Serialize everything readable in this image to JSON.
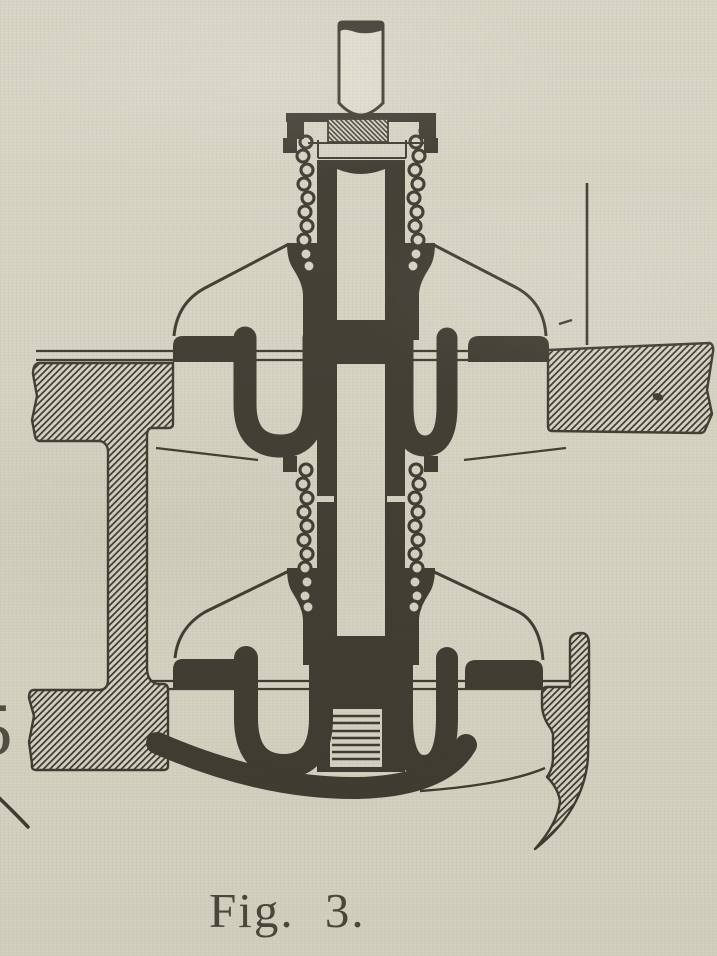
{
  "palette": {
    "paper": "#d7d4c4",
    "paper_light": "#dedbcc",
    "ink": "#3c392f"
  },
  "figure": {
    "caption": "Fig. 3."
  },
  "margin": {
    "partial_character": "5"
  }
}
